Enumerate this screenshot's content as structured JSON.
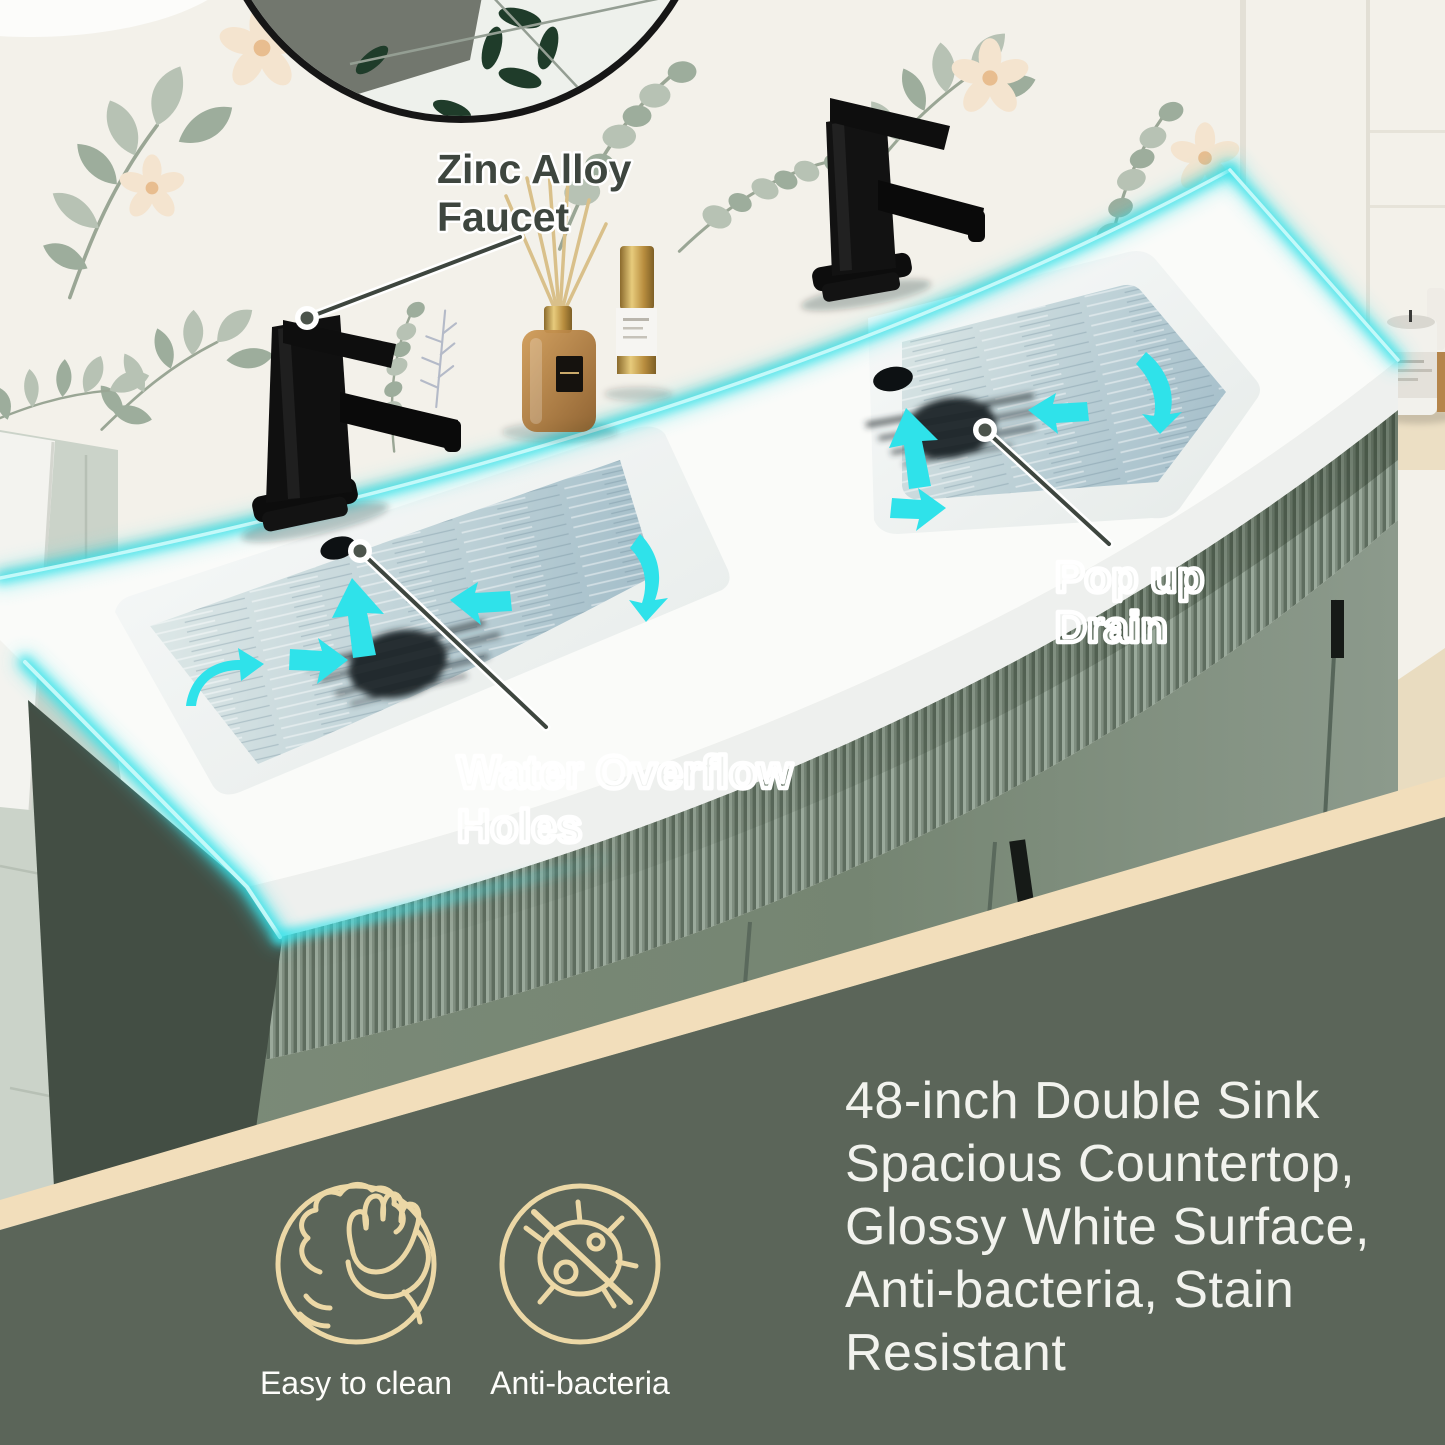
{
  "annotations": {
    "faucet_callout": {
      "lines": [
        "Zinc Alloy",
        "Faucet"
      ]
    },
    "overflow_callout": {
      "lines": [
        "Water Overflow",
        "Holes"
      ]
    },
    "drain_callout": {
      "lines": [
        "Pop up",
        "Drain"
      ]
    }
  },
  "description_lines": [
    "48-inch Double Sink",
    "Spacious Countertop,",
    "Glossy White Surface,",
    "Anti-bacteria, Stain",
    "Resistant"
  ],
  "features": [
    {
      "icon": "wipe-hand-icon",
      "label": "Easy to clean"
    },
    {
      "icon": "no-bacteria-icon",
      "label": "Anti-bacteria"
    }
  ],
  "colors": {
    "accent_cyan": "#38e2e9",
    "ribbon_cream": "#f2debb",
    "icon_cream": "#ecd8a6",
    "panel_green": "#5b6559",
    "annotation_dark": "#3e463f",
    "cabinet_sage": "#7e8d7b",
    "counter_white": "#fafbf9"
  }
}
